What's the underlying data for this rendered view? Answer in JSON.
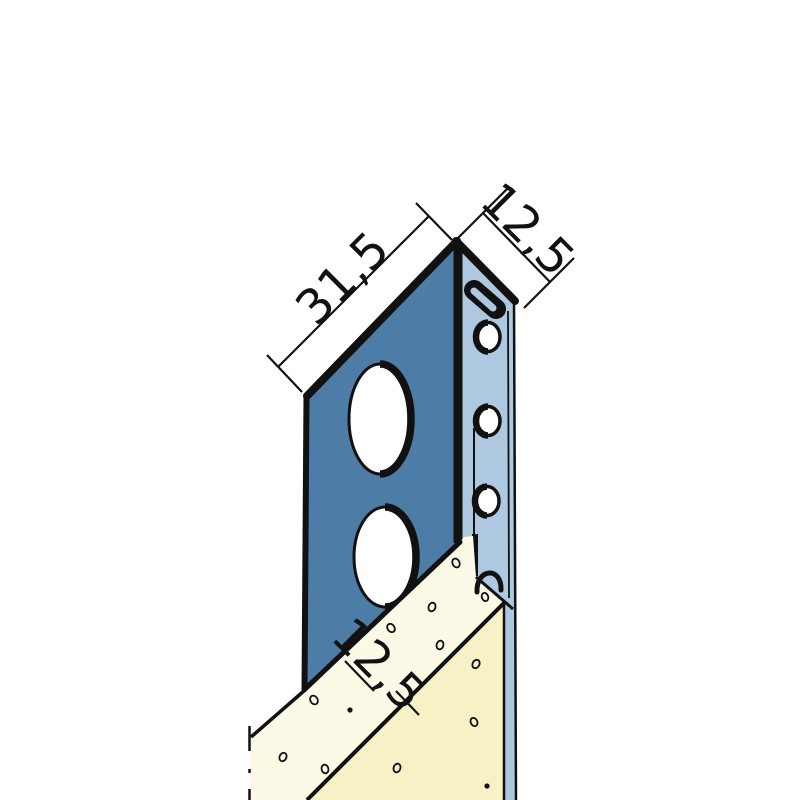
{
  "diagram": {
    "title": "edge-profile-technical-drawing",
    "dimensions": {
      "flange_width": "31,5",
      "channel_depth": "12,5",
      "board_thickness": "12,5"
    },
    "colors": {
      "front_flange": "#4d7ca6",
      "back_strip": "#aec8e0",
      "board_top": "#fcf9e7",
      "board_front": "#f8f1c5",
      "hole_fill": "#ffffff",
      "outline": "#111111",
      "background": "#ffffff"
    }
  }
}
